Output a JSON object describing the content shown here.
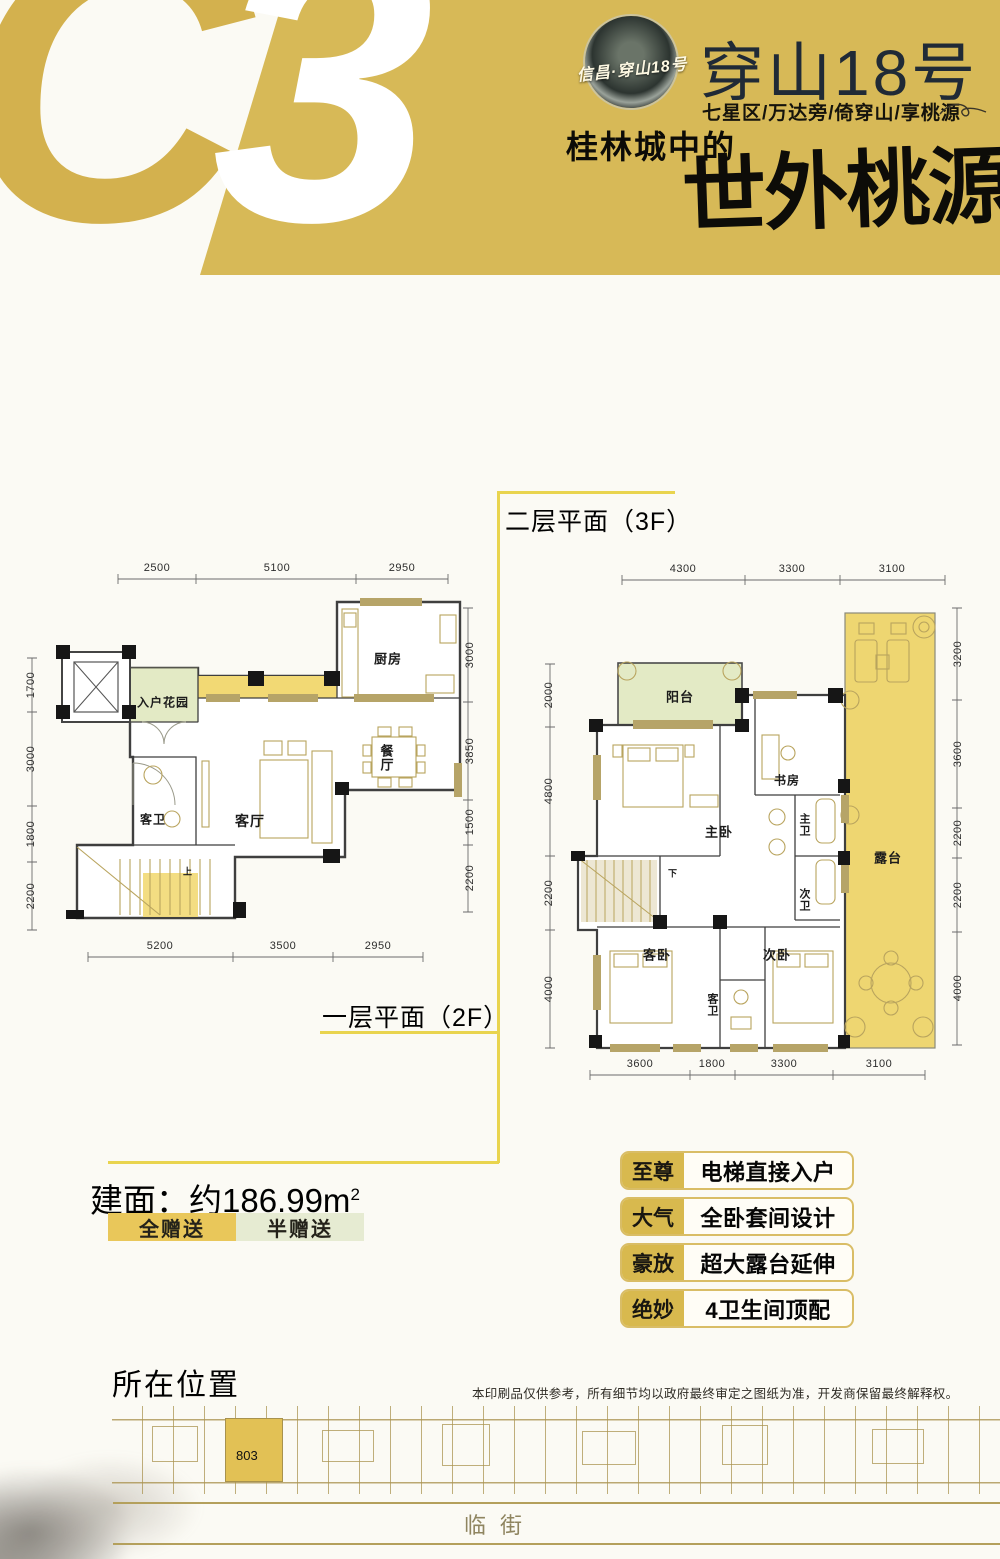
{
  "palette": {
    "banner_gold": "#d7b957",
    "full_gift_yellow": "#f2d974",
    "terrace_yellow": "#eed671",
    "half_gift_green": "#e3eac5",
    "guide_yellow": "#e9d44e",
    "feature_gold": "#d8b94e",
    "wall_dark": "#3f3f3f",
    "furniture_tan": "#b9a45e"
  },
  "header": {
    "unit_code_c": "C",
    "unit_code_3": "3",
    "logo_script": "信昌·穿山18号",
    "title": "穿山18号",
    "subtitle": "七星区/万达旁/倚穿山/享桃源",
    "slogan_prefix": "桂林城中的",
    "slogan_main": "世外桃源"
  },
  "area": {
    "label": "建面：约186.99m",
    "sup": "2",
    "value_sqm": "186.99"
  },
  "legend": [
    {
      "label": "全赠送",
      "color": "#e9c75a"
    },
    {
      "label": "半赠送",
      "color": "#e6ebd2"
    }
  ],
  "features": [
    {
      "tag": "至尊",
      "desc": "电梯直接入户"
    },
    {
      "tag": "大气",
      "desc": "全卧套间设计"
    },
    {
      "tag": "豪放",
      "desc": "超大露台延伸"
    },
    {
      "tag": "绝妙",
      "desc": "4卫生间顶配"
    }
  ],
  "location": {
    "title": "所在位置",
    "disclaimer": "本印刷品仅供参考，所有细节均以政府最终审定之图纸为准，开发商保留最终解释权。",
    "unit_label": "803",
    "street_label": "临街"
  },
  "plans": {
    "lower": {
      "title": "一层平面（2F）",
      "labels": [
        {
          "t": "2500",
          "x": 137,
          "y": 13,
          "n": "dim-label"
        },
        {
          "t": "5100",
          "x": 257,
          "y": 13,
          "n": "dim-label"
        },
        {
          "t": "2950",
          "x": 382,
          "y": 13,
          "n": "dim-label"
        },
        {
          "t": "5200",
          "x": 140,
          "y": 391,
          "n": "dim-label"
        },
        {
          "t": "3500",
          "x": 263,
          "y": 391,
          "n": "dim-label"
        },
        {
          "t": "2950",
          "x": 358,
          "y": 391,
          "n": "dim-label"
        },
        {
          "t": "1700",
          "x": 11,
          "y": 130,
          "v": 1,
          "n": "dim-label"
        },
        {
          "t": "3000",
          "x": 11,
          "y": 204,
          "v": 1,
          "n": "dim-label"
        },
        {
          "t": "1800",
          "x": 11,
          "y": 279,
          "v": 1,
          "n": "dim-label"
        },
        {
          "t": "2200",
          "x": 11,
          "y": 341,
          "v": 1,
          "n": "dim-label"
        },
        {
          "t": "3000",
          "x": 450,
          "y": 100,
          "v": 1,
          "n": "dim-label"
        },
        {
          "t": "3850",
          "x": 450,
          "y": 196,
          "v": 1,
          "n": "dim-label"
        },
        {
          "t": "1500",
          "x": 450,
          "y": 267,
          "v": 1,
          "n": "dim-label"
        },
        {
          "t": "2200",
          "x": 450,
          "y": 323,
          "v": 1,
          "n": "dim-label"
        },
        {
          "t": "入户花园",
          "x": 143,
          "y": 147,
          "fs": 12,
          "b": 1,
          "n": "room-label-entry-garden"
        },
        {
          "t": "厨房",
          "x": 368,
          "y": 103,
          "fs": 13,
          "b": 1,
          "n": "room-label-kitchen"
        },
        {
          "t": "餐厅",
          "x": 366,
          "y": 203,
          "s": 1,
          "fs": 13,
          "b": 1,
          "n": "room-label-dining"
        },
        {
          "t": "客卫",
          "x": 133,
          "y": 264,
          "fs": 12,
          "b": 1,
          "n": "room-label-guest-bath"
        },
        {
          "t": "客厅",
          "x": 230,
          "y": 266,
          "fs": 14,
          "b": 1,
          "n": "room-label-living"
        },
        {
          "t": "上",
          "x": 168,
          "y": 316,
          "fs": 9,
          "b": 1,
          "n": "stairs-up-label"
        }
      ]
    },
    "upper": {
      "title": "二层平面（3F）",
      "labels": [
        {
          "t": "4300",
          "x": 158,
          "y": 14,
          "n": "dim-label"
        },
        {
          "t": "3300",
          "x": 267,
          "y": 14,
          "n": "dim-label"
        },
        {
          "t": "3100",
          "x": 367,
          "y": 14,
          "n": "dim-label"
        },
        {
          "t": "3600",
          "x": 115,
          "y": 509,
          "n": "dim-label"
        },
        {
          "t": "1800",
          "x": 187,
          "y": 509,
          "n": "dim-label"
        },
        {
          "t": "3300",
          "x": 259,
          "y": 509,
          "n": "dim-label"
        },
        {
          "t": "3100",
          "x": 354,
          "y": 509,
          "n": "dim-label"
        },
        {
          "t": "2000",
          "x": 24,
          "y": 140,
          "v": 1,
          "n": "dim-label"
        },
        {
          "t": "4800",
          "x": 24,
          "y": 236,
          "v": 1,
          "n": "dim-label"
        },
        {
          "t": "2200",
          "x": 24,
          "y": 338,
          "v": 1,
          "n": "dim-label"
        },
        {
          "t": "4000",
          "x": 24,
          "y": 434,
          "v": 1,
          "n": "dim-label"
        },
        {
          "t": "3200",
          "x": 433,
          "y": 99,
          "v": 1,
          "n": "dim-label"
        },
        {
          "t": "3600",
          "x": 433,
          "y": 199,
          "v": 1,
          "n": "dim-label"
        },
        {
          "t": "2200",
          "x": 433,
          "y": 278,
          "v": 1,
          "n": "dim-label"
        },
        {
          "t": "2200",
          "x": 433,
          "y": 340,
          "v": 1,
          "n": "dim-label"
        },
        {
          "t": "4000",
          "x": 433,
          "y": 433,
          "v": 1,
          "n": "dim-label"
        },
        {
          "t": "阳台",
          "x": 155,
          "y": 141,
          "fs": 13,
          "b": 1,
          "n": "room-label-balcony"
        },
        {
          "t": "书房",
          "x": 262,
          "y": 225,
          "fs": 12,
          "b": 1,
          "n": "room-label-study"
        },
        {
          "t": "主卧",
          "x": 194,
          "y": 276,
          "fs": 13,
          "b": 1,
          "n": "room-label-master-bedroom"
        },
        {
          "t": "主卫",
          "x": 279,
          "y": 270,
          "s": 1,
          "fs": 11,
          "b": 1,
          "n": "room-label-master-bath"
        },
        {
          "t": "次卫",
          "x": 279,
          "y": 345,
          "s": 1,
          "fs": 11,
          "b": 1,
          "n": "room-label-second-bath"
        },
        {
          "t": "客卧",
          "x": 132,
          "y": 399,
          "fs": 13,
          "b": 1,
          "n": "room-label-guest-bedroom"
        },
        {
          "t": "次卧",
          "x": 252,
          "y": 399,
          "fs": 13,
          "b": 1,
          "n": "room-label-second-bedroom"
        },
        {
          "t": "客卫",
          "x": 187,
          "y": 450,
          "s": 1,
          "fs": 11,
          "b": 1,
          "n": "room-label-guest-bath"
        },
        {
          "t": "露台",
          "x": 363,
          "y": 302,
          "fs": 13,
          "b": 1,
          "n": "room-label-terrace"
        },
        {
          "t": "下",
          "x": 148,
          "y": 318,
          "fs": 9,
          "b": 1,
          "n": "stairs-down-label"
        }
      ]
    }
  }
}
